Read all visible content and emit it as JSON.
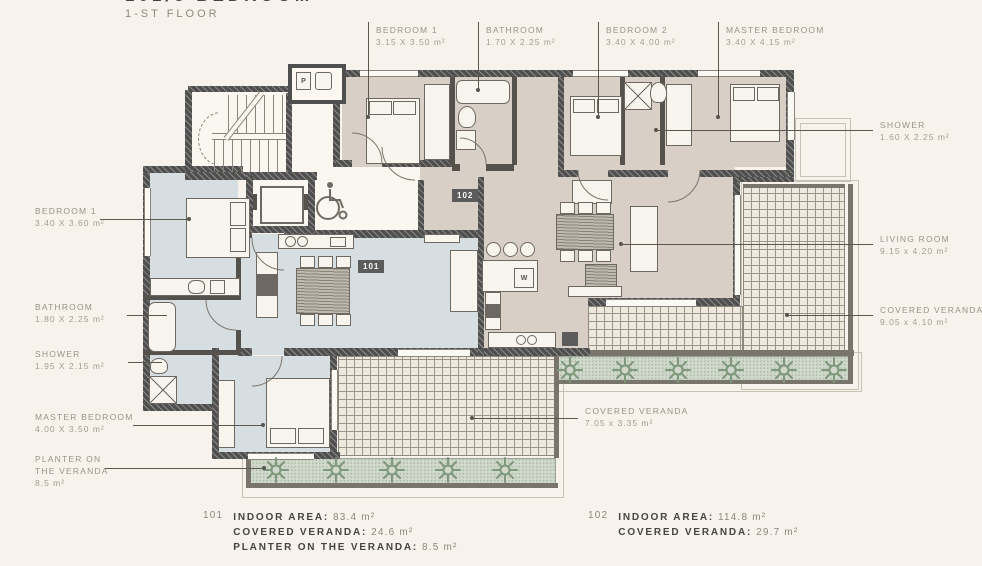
{
  "title": {
    "main": "101/3 BEDROOM",
    "floor": "1-ST FLOOR"
  },
  "units": {
    "left": {
      "id": "101"
    },
    "right": {
      "id": "102"
    }
  },
  "labels": {
    "top": [
      {
        "name": "BEDROOM 1",
        "dims": "3.15 X 3.50 m²"
      },
      {
        "name": "BATHROOM",
        "dims": "1.70 X 2.25 m²"
      },
      {
        "name": "BEDROOM 2",
        "dims": "3.40 X 4.00 m²"
      },
      {
        "name": "MASTER BEDROOM",
        "dims": "3.40 X 4.15 m²"
      }
    ],
    "right": [
      {
        "name": "SHOWER",
        "dims": "1.60 X 2.25 m²"
      },
      {
        "name": "LIVING ROOM",
        "dims": "9.15 x 4.20 m²"
      },
      {
        "name": "COVERED VERANDA",
        "dims": "9.05 x 4.10 m²"
      }
    ],
    "left": [
      {
        "name": "BEDROOM 1",
        "dims": "3.40 X 3.60 m²"
      },
      {
        "name": "BATHROOM",
        "dims": "1.80 X 2.25 m²"
      },
      {
        "name": "SHOWER",
        "dims": "1.95 X 2.15 m²"
      },
      {
        "name": "MASTER BEDROOM",
        "dims": "4.00 X 3.50 m²"
      },
      {
        "name": "PLANTER ON THE VERANDA",
        "dims": "8.5 m²"
      }
    ],
    "bottom": [
      {
        "name": "COVERED VERANDA",
        "dims": "7.05 x 3.35 m²"
      }
    ]
  },
  "summary": {
    "left": {
      "unit": "101",
      "rows": [
        {
          "label": "INDOOR AREA:",
          "value": "83.4 m²"
        },
        {
          "label": "COVERED VERANDA:",
          "value": "24.6 m²"
        },
        {
          "label": "PLANTER ON THE VERANDA:",
          "value": "8.5 m²"
        }
      ]
    },
    "right": {
      "unit": "102",
      "rows": [
        {
          "label": "INDOOR AREA:",
          "value": "114.8 m²"
        },
        {
          "label": "COVERED VERANDA:",
          "value": "29.7 m²"
        }
      ]
    }
  },
  "icons": {
    "washer": "W",
    "sink": "P"
  },
  "colors": {
    "background": "#f7f3ec",
    "wall": "#4f4f4f",
    "unit_101": "#d6dee2",
    "unit_102": "#d8d0c6",
    "planter": "#cfd8ca",
    "tile_line": "#9b958a",
    "label_text": "#98928a",
    "value_text": "#8d8880",
    "dark_text": "#45443e",
    "badge": "#5c5c5c"
  }
}
